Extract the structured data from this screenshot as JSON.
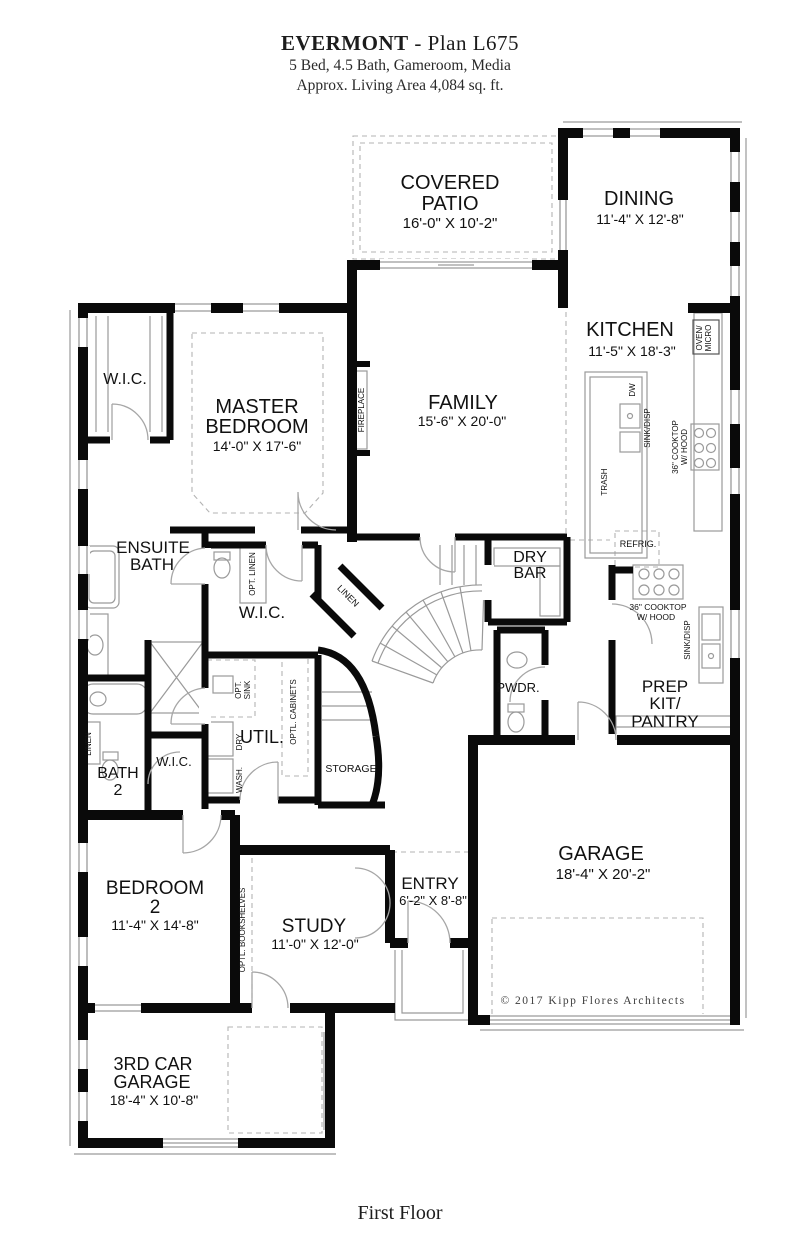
{
  "header": {
    "brand": "EVERMONT",
    "plan_suffix": "- Plan L675",
    "line2": "5 Bed, 4.5 Bath, Gameroom, Media",
    "line3": "Approx. Living Area 4,084 sq. ft."
  },
  "footer": {
    "title": "First Floor"
  },
  "plan": {
    "copyright": "© 2017 Kipp Flores Architects"
  },
  "rooms": {
    "covered_patio": {
      "l1": "COVERED",
      "l2": "PATIO",
      "dims": "16'-0\" X 10'-2\""
    },
    "dining": {
      "l1": "DINING",
      "dims": "11'-4\" X 12'-8\""
    },
    "kitchen": {
      "l1": "KITCHEN",
      "dims": "11'-5\" X 18'-3\""
    },
    "family": {
      "l1": "FAMILY",
      "dims": "15'-6\" X 20'-0\""
    },
    "master": {
      "l1": "MASTER",
      "l2": "BEDROOM",
      "dims": "14'-0\" X 17'-6\""
    },
    "wic1": {
      "l1": "W.I.C."
    },
    "wic2": {
      "l1": "W.I.C."
    },
    "wic3": {
      "l1": "W.I.C."
    },
    "ensuite": {
      "l1": "ENSUITE",
      "l2": "BATH"
    },
    "bath2": {
      "l1": "BATH",
      "l2": "2"
    },
    "util": {
      "l1": "UTIL."
    },
    "drybar": {
      "l1": "DRY",
      "l2": "BAR"
    },
    "pwdr": {
      "l1": "PWDR."
    },
    "prep": {
      "l1": "PREP",
      "l2": "KIT/",
      "l3": "PANTRY"
    },
    "bedroom2": {
      "l1": "BEDROOM",
      "l2": "2",
      "dims": "11'-4\" X 14'-8\""
    },
    "study": {
      "l1": "STUDY",
      "dims": "11'-0\" X 12'-0\""
    },
    "entry": {
      "l1": "ENTRY",
      "dims": "6'-2\" X 8'-8\""
    },
    "garage": {
      "l1": "GARAGE",
      "dims": "18'-4\" X 20'-2\""
    },
    "garage3": {
      "l1": "3RD CAR",
      "l2": "GARAGE",
      "dims": "18'-4\" X 10'-8\""
    },
    "storage": {
      "l1": "STORAGE"
    }
  },
  "features": {
    "fireplace": "FIREPLACE",
    "opt_linen": "OPT. LINEN",
    "linen_diag": "LINEN",
    "linen_bath": "LINEN",
    "opt_sink_1": "OPT.",
    "opt_sink_2": "SINK",
    "optl_cabinets": "OPTL. CABINETS",
    "wash": "WASH.",
    "dry": "DRY",
    "optl_bookshelves": "OPTL. BOOKSHELVES",
    "trash": "TRASH",
    "dw": "DW",
    "sink_disp_island": "SINK/DISP",
    "cooktop_k1": "36\" COOKTOP",
    "cooktop_k2": "W/ HOOD",
    "oven1": "OVEN/",
    "oven2": "MICRO",
    "refrig": "REFRIG.",
    "cooktop_p1": "36\" COOKTOP",
    "cooktop_p2": "W/ HOOD",
    "sink_disp_pantry": "SINK/DISP"
  }
}
